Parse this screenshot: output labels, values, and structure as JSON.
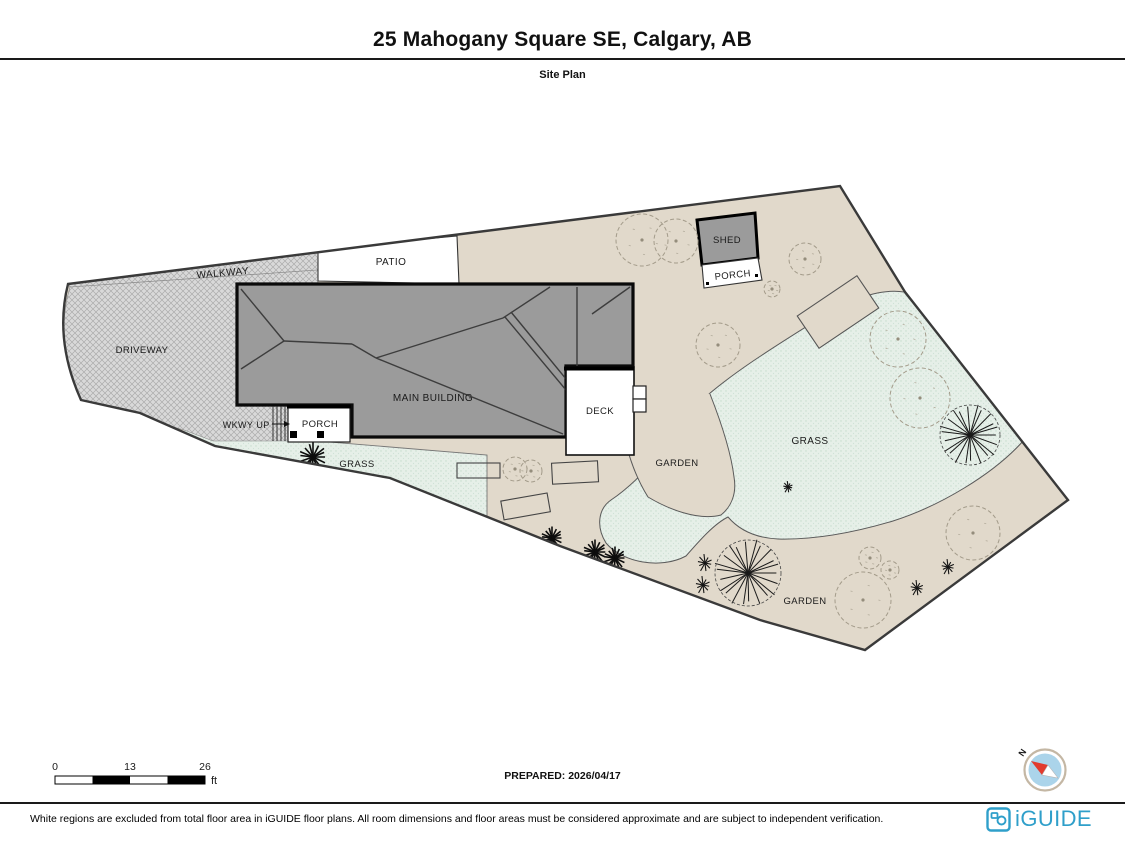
{
  "header": {
    "title": "25 Mahogany Square SE, Calgary, AB",
    "subtitle": "Site Plan"
  },
  "plan": {
    "labels": {
      "driveway": "DRIVEWAY",
      "walkway": "WALKWAY",
      "patio": "PATIO",
      "main_building": "MAIN BUILDING",
      "wkwy": "WKWY",
      "up": "UP",
      "porch_main": "PORCH",
      "deck": "DECK",
      "grass_left": "GRASS",
      "grass_right": "GRASS",
      "garden_mid": "GARDEN",
      "garden_bottom": "GARDEN",
      "shed": "SHED",
      "porch_shed": "PORCH"
    }
  },
  "scale_bar": {
    "tick0": "0",
    "tick1": "13",
    "tick2": "26",
    "unit": "ft"
  },
  "prepared": "PREPARED: 2026/04/17",
  "compass": {
    "north_label": "N"
  },
  "footer": {
    "disclaimer": "White regions are excluded from total floor area in iGUIDE floor plans. All room dimensions and floor areas must be considered approximate and are subject to independent verification.",
    "brand": "iGUIDE"
  },
  "colors": {
    "brand_blue": "#2f9fca",
    "parcel_beige": "#e1d9cb",
    "grass_mint": "#e6efe8",
    "building_gray": "#9b9b9b",
    "compass_disc": "#abd4ea",
    "compass_needle_red": "#e23b2e"
  }
}
